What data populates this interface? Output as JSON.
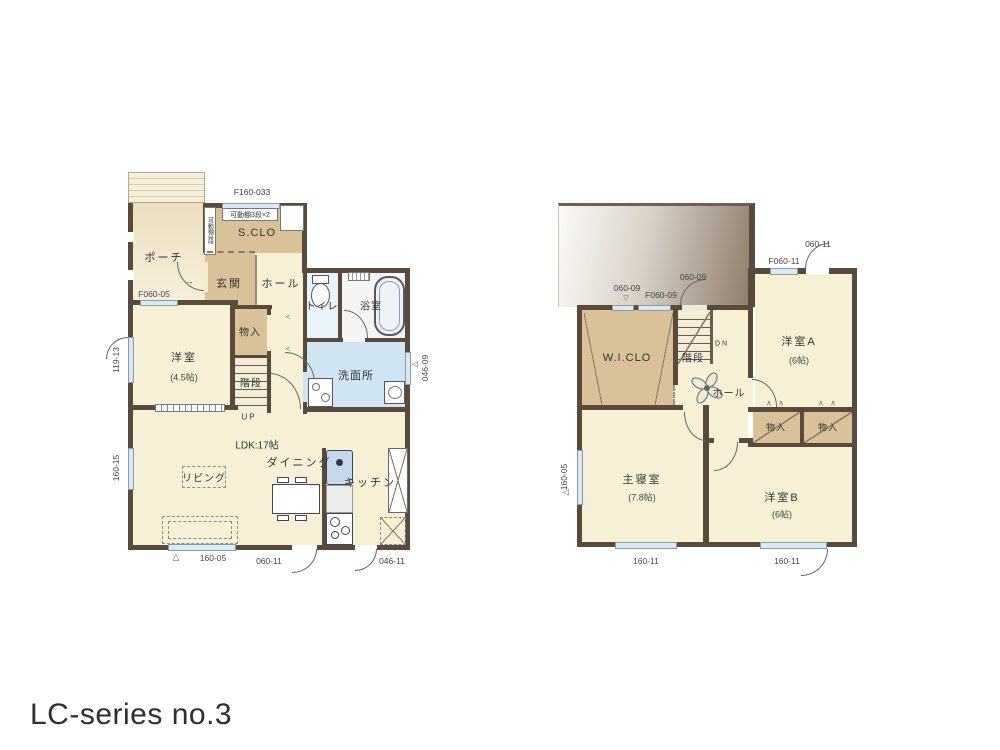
{
  "page_title": "LC-series no.3",
  "colors": {
    "wall": "#5a4a3c",
    "floor_cream": "#f7efd6",
    "floor_tan": "#d9c298",
    "floor_washroom": "#cfe5f3",
    "floor_toilet": "#e9f3fa",
    "window": "#d8eaf6",
    "roof_dark": "#8e7e6d"
  },
  "markers": {
    "triangle_up": "△",
    "triangle_down": "▽",
    "triangle_left": "◁",
    "fold": "∧ ∧",
    "fold_small": "<",
    "entry_arrow": "→"
  },
  "floor1": {
    "labels": {
      "porch": "ポーチ",
      "sclo": "S.CLO",
      "sclo_shelf": "可動棚3段×2",
      "sclo_shelf_side": "可動棚3段",
      "genkan": "玄関",
      "hall": "ホール",
      "toilet": "トイレ",
      "bath": "浴室",
      "storage": "物入",
      "stairs": "階段",
      "stairs_dir": "UP",
      "bedroom": "洋室",
      "bedroom_size": "(4.5帖)",
      "washroom": "洗面所",
      "ldk": "LDK:17帖",
      "dining": "ダイニング",
      "living": "リビング",
      "kitchen": "キッチン"
    },
    "dims": {
      "top_window": "F160-033",
      "porch_window": "F060-05",
      "left_window_upper": "119-13",
      "left_window_lower": "160-15",
      "right_window": "046-09",
      "bottom_window": "160-05",
      "bottom_door_center": "060-11",
      "bottom_door_right": "046-11"
    }
  },
  "floor2": {
    "labels": {
      "wiclo": "W.I.CLO",
      "stairs": "階段",
      "stairs_dir": "DN",
      "hall": "ホール",
      "bedroomA": "洋室A",
      "bedroomA_size": "(6帖)",
      "master": "主寝室",
      "master_size": "(7.8帖)",
      "bedroomB": "洋室B",
      "bedroomB_size": "(6帖)",
      "storage1": "物入",
      "storage2": "物入"
    },
    "dims": {
      "top_window1": "060-09",
      "top_window2": "F060-09",
      "top_door": "060-09",
      "a_window": "F060-11",
      "a_door": "060-11",
      "left_window": "160-05",
      "bottom_window1": "160-11",
      "bottom_window2": "160-11"
    }
  }
}
